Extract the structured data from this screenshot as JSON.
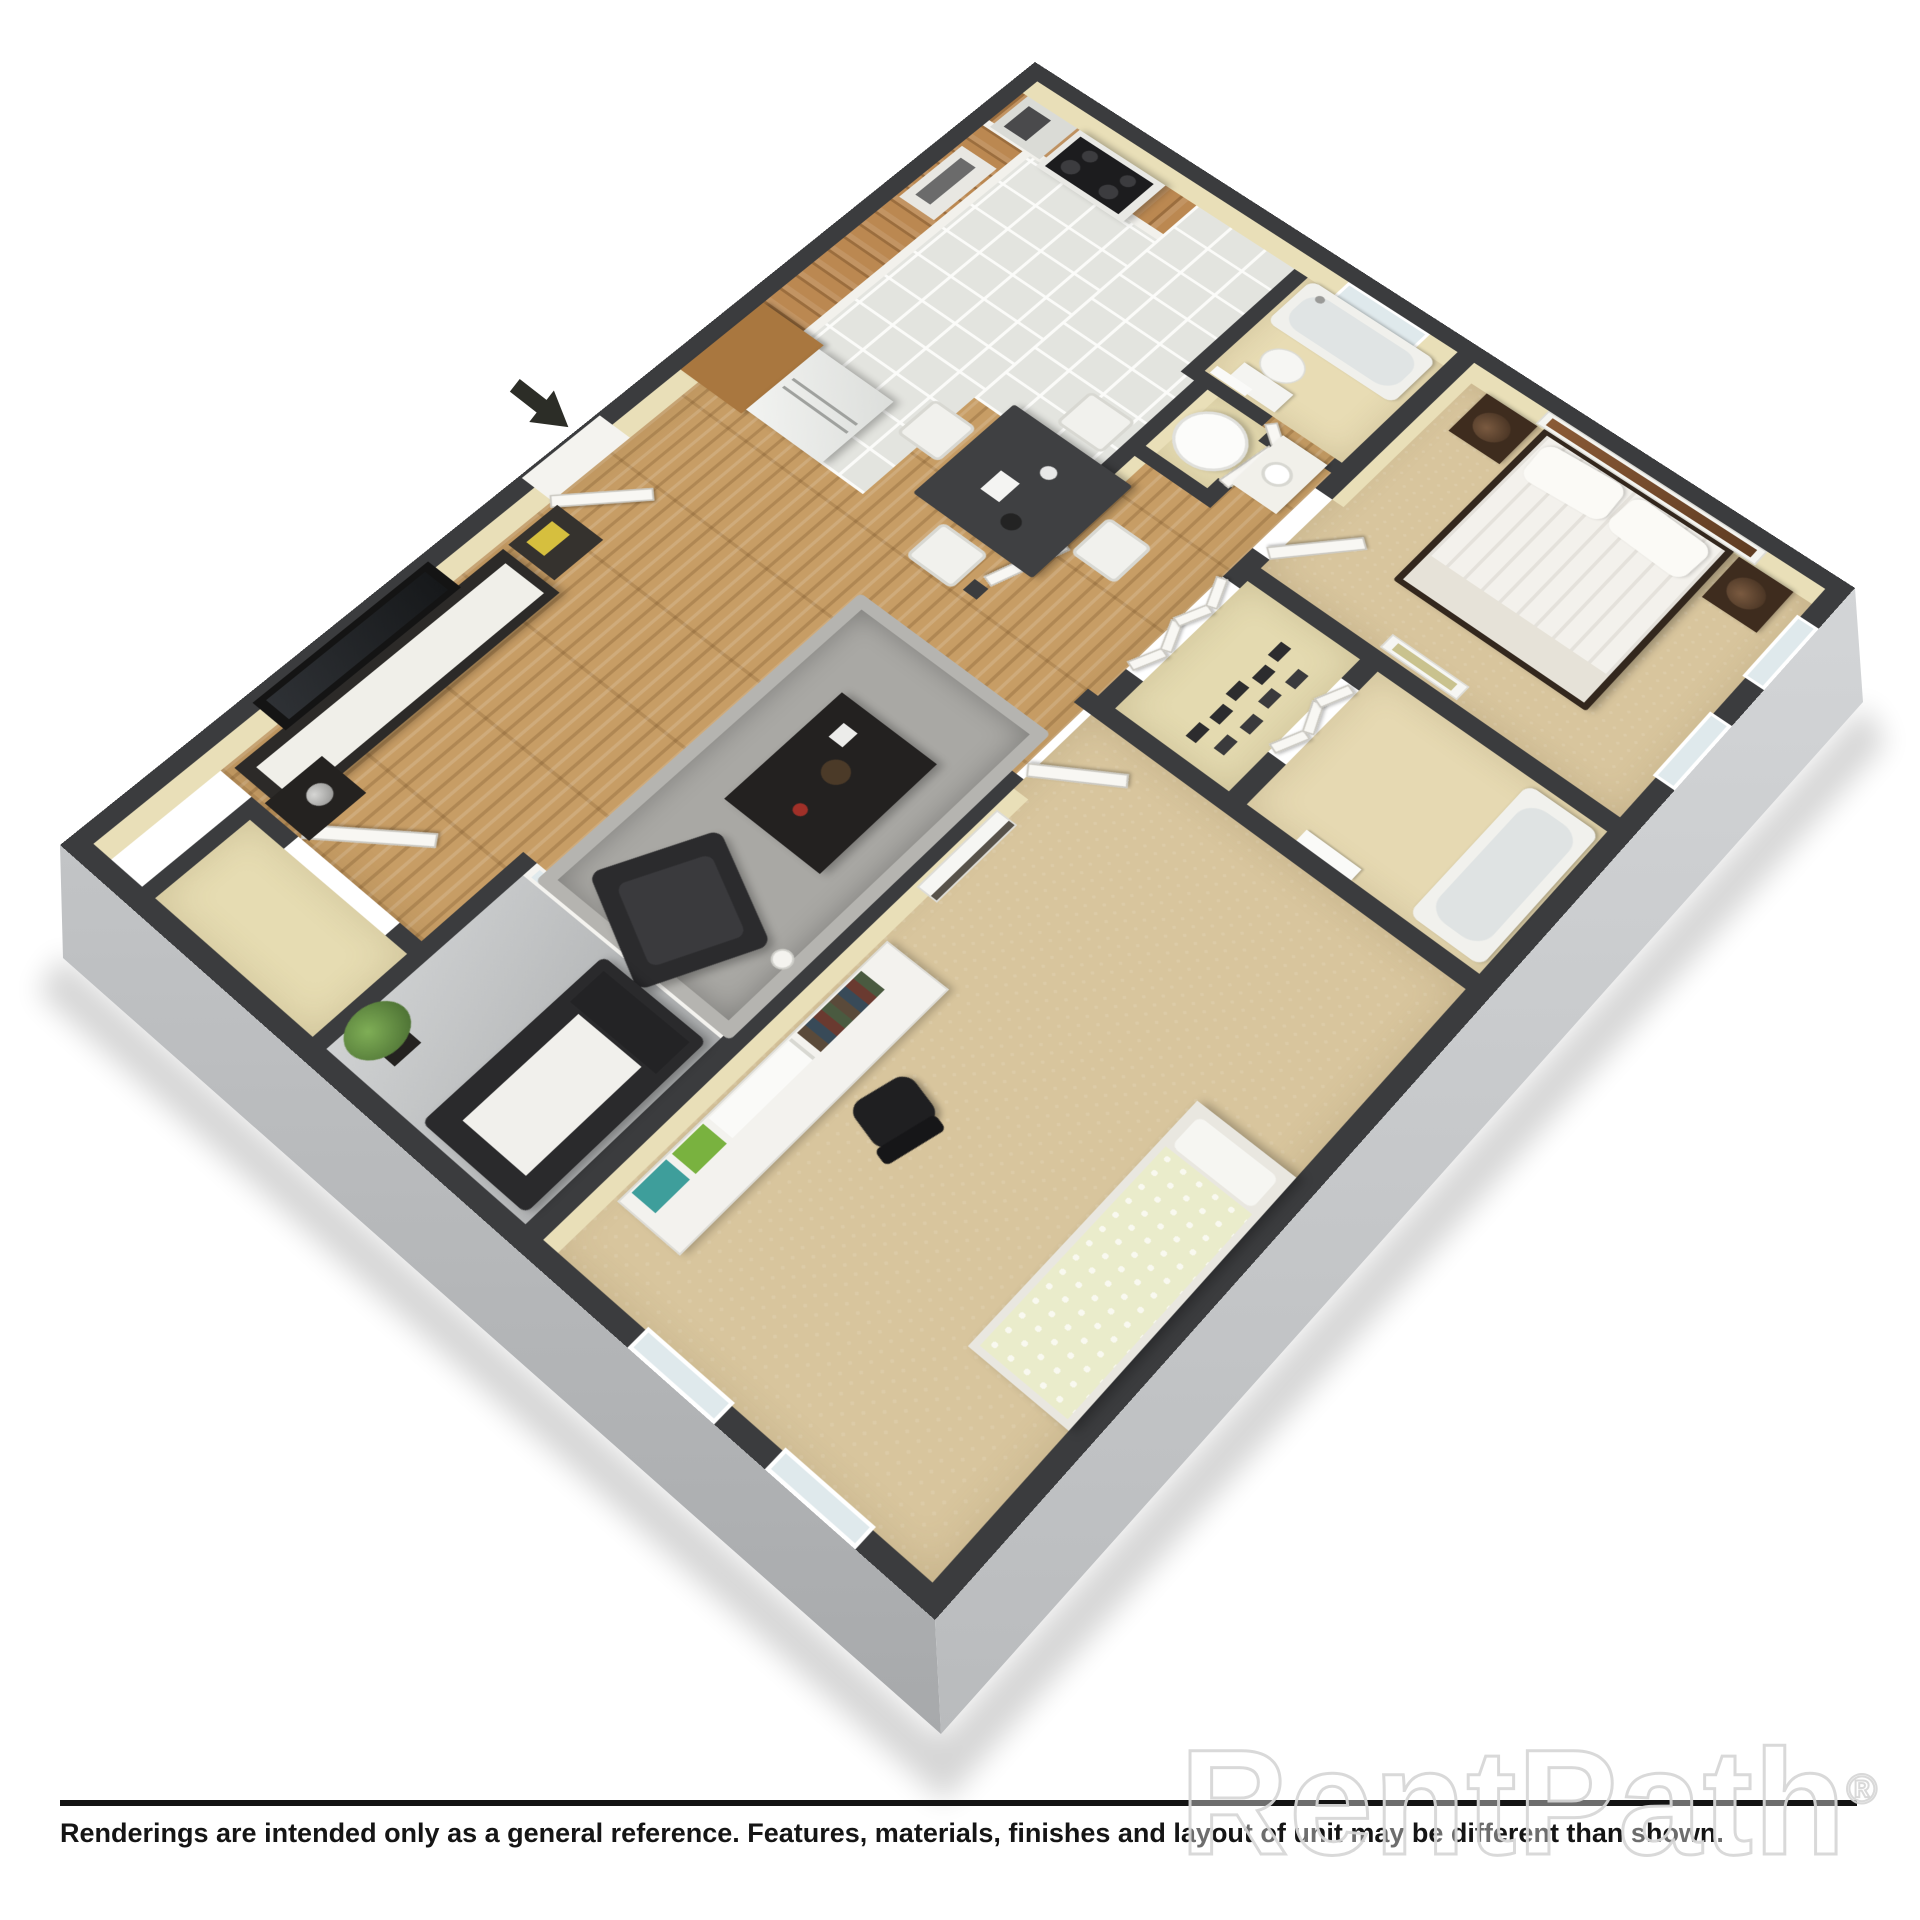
{
  "image_type": "3d-isometric-floorplan-rendering",
  "footer": {
    "disclaimer": "Renderings are intended only as a general reference. Features, materials, finishes and layout of unit may be different than shown."
  },
  "watermark": {
    "text": "RentPath",
    "registered_mark": "®"
  },
  "icons": {
    "entry_arrow": "arrow-southeast-icon"
  },
  "palette": {
    "background": "#ffffff",
    "wall_top": "#3b3c3e",
    "wall_inner_face": "#e9dfb8",
    "exterior_face_west": "#b2b4b6",
    "exterior_face_east": "#c8cacc",
    "carpet": "#d8c59d",
    "wood_floor": "#c79d65",
    "kitchen_tile": "#e3e4df",
    "balcony_concrete": "#bcbec0",
    "cabinet_wood": "#bb8851",
    "dark_furniture": "#2c2a28",
    "bed2_duvet": "#eaeccb",
    "disclaimer_text": "#151515",
    "watermark_outline": "#d7d7d7"
  },
  "floorplan": {
    "rooms": [
      "living-room",
      "dining-area",
      "kitchen",
      "entry",
      "coat-closet",
      "balcony",
      "hallway",
      "bathroom-1",
      "utility-closet",
      "master-bedroom",
      "shoe-closet",
      "bathroom-2",
      "bedroom-2"
    ],
    "furniture": [
      "tv-console",
      "tv",
      "media-tower",
      "rug",
      "coffee-table",
      "lounge-chair",
      "floor-lamp",
      "dining-table",
      "dining-chairs",
      "refrigerator",
      "range",
      "microwave",
      "wall-oven",
      "upper-cabinets",
      "queen-bed",
      "nightstands",
      "table-lamps",
      "wall-art",
      "toilet",
      "bathtubs",
      "vanity-sink",
      "water-heater",
      "desk-with-hutch",
      "office-chair",
      "twin-bed",
      "loveseat",
      "potted-plant"
    ]
  }
}
